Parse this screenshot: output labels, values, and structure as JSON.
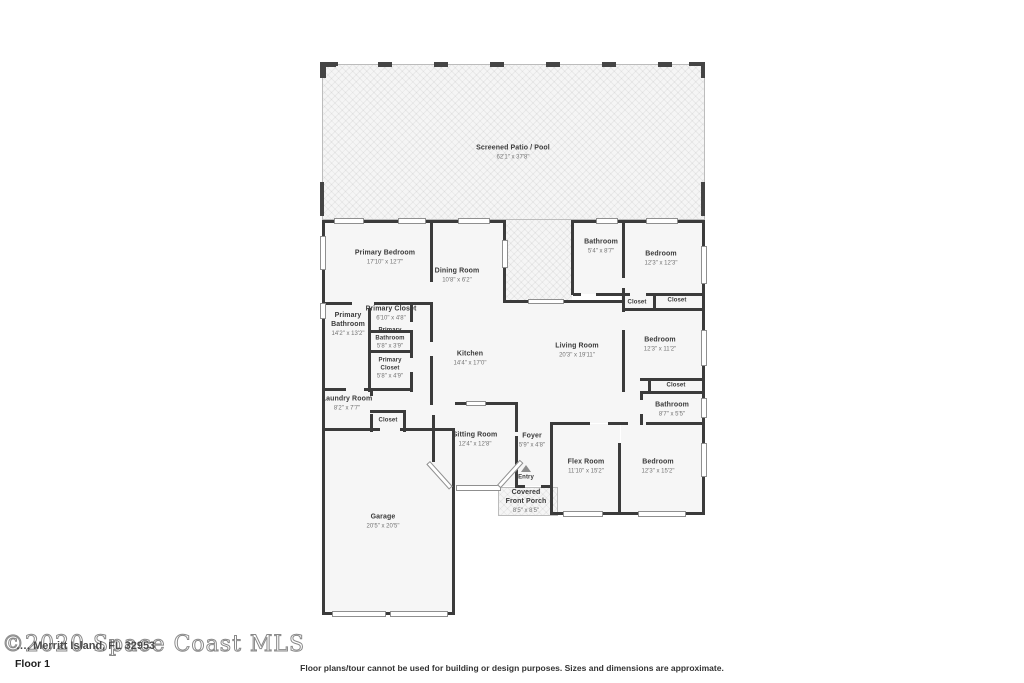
{
  "floor_label": "Floor 1",
  "watermark": {
    "mls_text": "©2020 Space Coast MLS",
    "address_text": "…, Merritt Island, FL 32953"
  },
  "disclaimer": "Floor plans/tour cannot be used for building or design purposes. Sizes and dimensions are approximate.",
  "rooms": [
    {
      "id": "screened-patio",
      "name": "Screened Patio / Pool",
      "dims": "62'1\" x 37'8\"",
      "x": 513,
      "y": 153,
      "w": 120,
      "small": false
    },
    {
      "id": "primary-bedroom",
      "name": "Primary Bedroom",
      "dims": "17'10\" x 12'7\"",
      "x": 385,
      "y": 258,
      "w": 90,
      "small": false
    },
    {
      "id": "dining-room",
      "name": "Dining Room",
      "dims": "10'8\" x 6'2\"",
      "x": 457,
      "y": 276,
      "w": 70,
      "small": false
    },
    {
      "id": "bathroom-top-right",
      "name": "Bathroom",
      "dims": "5'4\" x 8'7\"",
      "x": 601,
      "y": 247,
      "w": 44,
      "small": false
    },
    {
      "id": "bedroom-top-right",
      "name": "Bedroom",
      "dims": "12'3\" x 12'3\"",
      "x": 661,
      "y": 259,
      "w": 70,
      "small": false
    },
    {
      "id": "closet-1",
      "name": "Closet",
      "dims": "",
      "x": 637,
      "y": 303,
      "w": 34,
      "small": true
    },
    {
      "id": "closet-2",
      "name": "Closet",
      "dims": "",
      "x": 677,
      "y": 301,
      "w": 34,
      "small": true
    },
    {
      "id": "bedroom-mid-right",
      "name": "Bedroom",
      "dims": "12'3\" x 11'2\"",
      "x": 660,
      "y": 345,
      "w": 70,
      "small": false
    },
    {
      "id": "closet-3",
      "name": "Closet",
      "dims": "",
      "x": 676,
      "y": 386,
      "w": 34,
      "small": true
    },
    {
      "id": "bathroom-mid-right",
      "name": "Bathroom",
      "dims": "8'7\" x 5'5\"",
      "x": 672,
      "y": 410,
      "w": 60,
      "small": false
    },
    {
      "id": "kitchen",
      "name": "Kitchen",
      "dims": "14'4\" x 17'0\"",
      "x": 470,
      "y": 359,
      "w": 60,
      "small": false
    },
    {
      "id": "living-room",
      "name": "Living Room",
      "dims": "20'3\" x 19'11\"",
      "x": 577,
      "y": 351,
      "w": 70,
      "small": false
    },
    {
      "id": "primary-bathroom",
      "name": "Primary Bathroom",
      "dims": "14'2\" x 13'2\"",
      "x": 348,
      "y": 325,
      "w": 40,
      "small": false
    },
    {
      "id": "primary-closet-1",
      "name": "Primary Closet",
      "dims": "6'10\" x 4'8\"",
      "x": 391,
      "y": 314,
      "w": 70,
      "small": false
    },
    {
      "id": "primary-bathroom-2",
      "name": "Primary Bathroom",
      "dims": "5'8\" x 3'9\"",
      "x": 390,
      "y": 339,
      "w": 40,
      "small": true
    },
    {
      "id": "primary-closet-2",
      "name": "Primary Closet",
      "dims": "5'8\" x 4'9\"",
      "x": 390,
      "y": 369,
      "w": 40,
      "small": true
    },
    {
      "id": "laundry-room",
      "name": "Laundry Room",
      "dims": "8'2\" x 7'7\"",
      "x": 347,
      "y": 404,
      "w": 60,
      "small": false
    },
    {
      "id": "closet-4",
      "name": "Closet",
      "dims": "",
      "x": 388,
      "y": 421,
      "w": 34,
      "small": true
    },
    {
      "id": "sitting-room",
      "name": "Sitting Room",
      "dims": "12'4\" x 12'8\"",
      "x": 475,
      "y": 440,
      "w": 70,
      "small": false
    },
    {
      "id": "foyer",
      "name": "Foyer",
      "dims": "5'9\" x 4'8\"",
      "x": 532,
      "y": 441,
      "w": 40,
      "small": false
    },
    {
      "id": "entry",
      "name": "Entry",
      "dims": "",
      "x": 526,
      "y": 478,
      "w": 34,
      "small": true
    },
    {
      "id": "covered-front-porch",
      "name": "Covered Front Porch",
      "dims": "8'5\" x 8'5\"",
      "x": 526,
      "y": 502,
      "w": 46,
      "small": false
    },
    {
      "id": "flex-room",
      "name": "Flex Room",
      "dims": "11'10\" x 15'2\"",
      "x": 586,
      "y": 467,
      "w": 60,
      "small": false
    },
    {
      "id": "bedroom-bottom-right",
      "name": "Bedroom",
      "dims": "12'3\" x 15'2\"",
      "x": 658,
      "y": 467,
      "w": 70,
      "small": false
    },
    {
      "id": "garage",
      "name": "Garage",
      "dims": "20'5\" x 20'5\"",
      "x": 383,
      "y": 522,
      "w": 70,
      "small": false
    }
  ]
}
